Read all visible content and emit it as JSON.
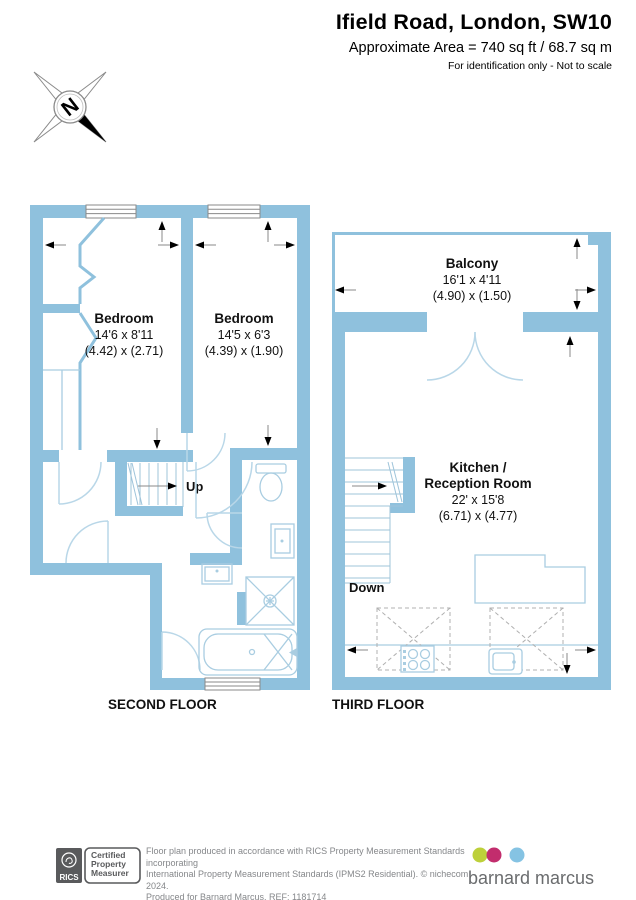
{
  "header": {
    "title": "Ifield Road, London, SW10",
    "area_line": "Approximate Area = 740 sq ft / 68.7 sq m",
    "note": "For identification only - Not to scale"
  },
  "compass": {
    "north": "N"
  },
  "second_floor": {
    "label": "SECOND FLOOR",
    "stairs": "Up",
    "bedroom1": {
      "name": "Bedroom",
      "imperial": "14'6 x 8'11",
      "metric": "(4.42) x (2.71)"
    },
    "bedroom2": {
      "name": "Bedroom",
      "imperial": "14'5 x 6'3",
      "metric": "(4.39) x (1.90)"
    }
  },
  "third_floor": {
    "label": "THIRD FLOOR",
    "stairs": "Down",
    "balcony": {
      "name": "Balcony",
      "imperial": "16'1 x 4'11",
      "metric": "(4.90) x (1.50)"
    },
    "kitchen": {
      "name_line1": "Kitchen /",
      "name_line2": "Reception Room",
      "imperial": "22' x 15'8",
      "metric": "(6.71) x (4.77)"
    }
  },
  "footer": {
    "rics_brand": "RICS",
    "badge_line1": "Certified",
    "badge_line2": "Property",
    "badge_line3": "Measurer",
    "disclaimer_line1": "Floor plan produced in accordance with RICS Property Measurement Standards incorporating",
    "disclaimer_line2": "International Property Measurement Standards (IPMS2 Residential).  © nichecom 2024.",
    "disclaimer_line3": "Produced for Barnard Marcus.   REF: 1181714",
    "agency": "barnard marcus"
  },
  "colors": {
    "wall": "#8fc1dd",
    "fixture_line": "#a9cde1",
    "dot_green": "#bdd03a",
    "dot_magenta": "#c22d6d",
    "dot_blue": "#85c3e3"
  }
}
